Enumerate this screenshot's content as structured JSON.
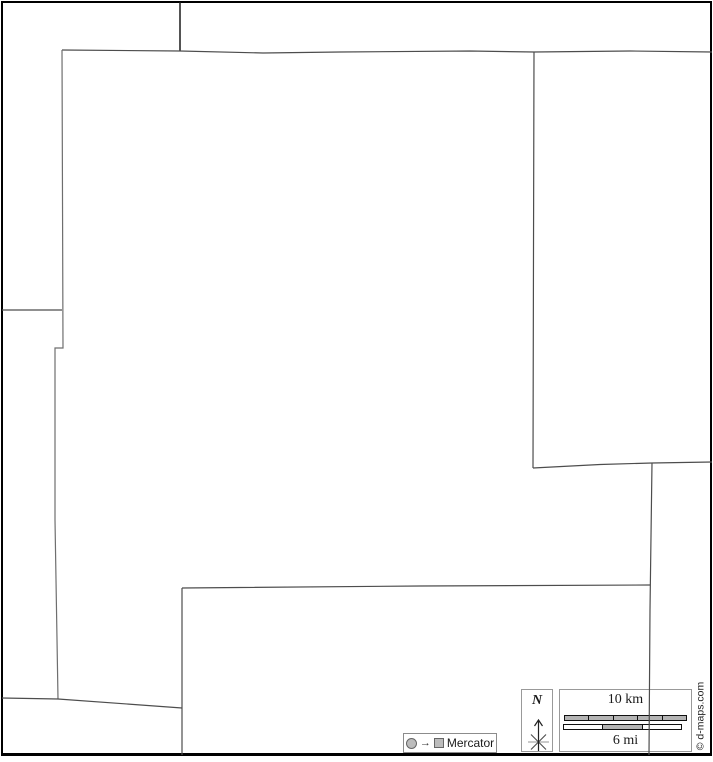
{
  "legend": {
    "projection": {
      "arrow_char": "→",
      "label": "Mercator"
    },
    "north": {
      "label": "N"
    },
    "scalebar": {
      "km": {
        "label": "10 km",
        "fills": [
          "g",
          "g",
          "g",
          "g",
          "g"
        ]
      },
      "mi": {
        "label": "6 mi",
        "fills": [
          "w",
          "g",
          "w"
        ]
      }
    },
    "copyright": "© d-maps.com"
  },
  "colors": {
    "frame": "#000000",
    "boundary": "#434343",
    "box_border": "#999999",
    "bar_fill": "#b4b4b4",
    "background": "#ffffff"
  },
  "map": {
    "polylines": [
      {
        "name": "top-tab-boundary",
        "w": 1.5,
        "c": "#1a1a1a",
        "points": [
          [
            180,
            2
          ],
          [
            180,
            51
          ]
        ]
      },
      {
        "name": "north-boundary",
        "w": 1.2,
        "c": "#4d4d4d",
        "points": [
          [
            62,
            50
          ],
          [
            180,
            51
          ],
          [
            263,
            53
          ],
          [
            340,
            52
          ],
          [
            470,
            51
          ],
          [
            534,
            52
          ],
          [
            630,
            51
          ],
          [
            712,
            52
          ]
        ]
      },
      {
        "name": "east-upper-boundary",
        "w": 1.2,
        "c": "#4d4d4d",
        "points": [
          [
            534,
            52
          ],
          [
            533.5,
            250
          ],
          [
            533,
            468
          ]
        ]
      },
      {
        "name": "east-mid-boundary",
        "w": 1.2,
        "c": "#4d4d4d",
        "points": [
          [
            533,
            468
          ],
          [
            600,
            464.5
          ],
          [
            652,
            463
          ],
          [
            712,
            462
          ]
        ]
      },
      {
        "name": "east-lower-boundary",
        "w": 1.2,
        "c": "#4d4d4d",
        "points": [
          [
            652,
            463
          ],
          [
            650,
            610
          ],
          [
            649,
            755
          ]
        ]
      },
      {
        "name": "south-boundary",
        "w": 1.2,
        "c": "#4d4d4d",
        "points": [
          [
            182,
            588
          ],
          [
            420,
            586
          ],
          [
            650,
            585
          ]
        ]
      },
      {
        "name": "south-vertical-boundary",
        "w": 1.2,
        "c": "#4d4d4d",
        "points": [
          [
            182,
            588
          ],
          [
            182,
            755
          ]
        ]
      },
      {
        "name": "west-boundary",
        "w": 1.2,
        "c": "#6e6e6e",
        "points": [
          [
            62,
            50
          ],
          [
            63,
            348
          ],
          [
            55,
            348
          ],
          [
            55,
            520
          ],
          [
            58,
            699
          ]
        ]
      },
      {
        "name": "west-upper-connector",
        "w": 1.2,
        "c": "#4d4d4d",
        "points": [
          [
            2,
            310
          ],
          [
            62,
            310
          ]
        ]
      },
      {
        "name": "southwest-boundary",
        "w": 1.2,
        "c": "#4d4d4d",
        "points": [
          [
            2,
            698
          ],
          [
            58,
            699
          ],
          [
            182,
            708
          ]
        ]
      }
    ]
  }
}
